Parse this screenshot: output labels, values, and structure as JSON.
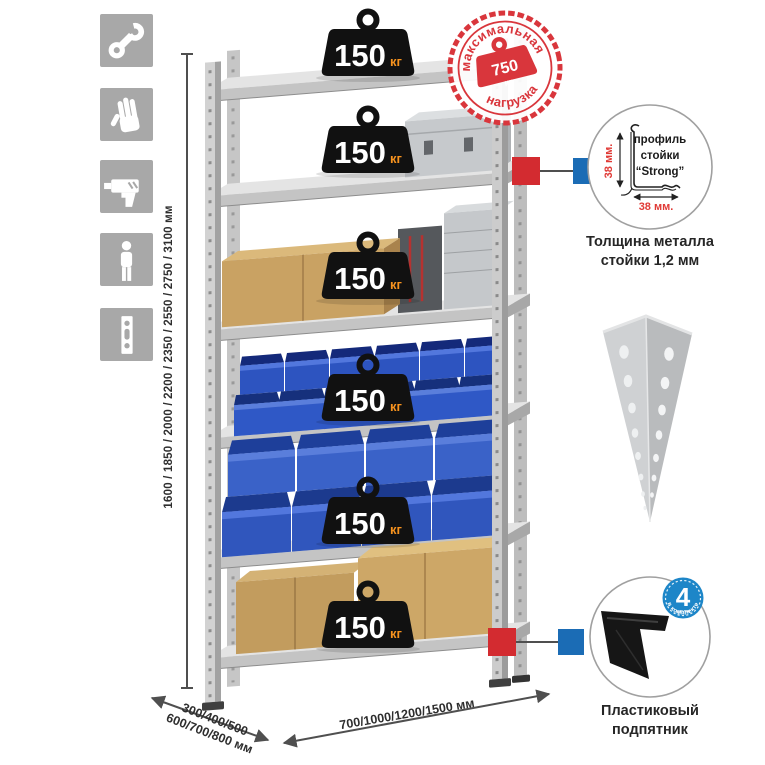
{
  "colors": {
    "icon-gray": "#a8a8a8",
    "stamp-red": "#d9363c",
    "weight-orange": "#f6921e",
    "dim-red": "#e03a36",
    "callout-red": "#d32b30",
    "callout-blue": "#1b6cb5",
    "badge-blue": "#1d86c8",
    "bin-blue": "#2d54c0",
    "metal-light": "#e4e4e4",
    "cardboard": "#c9a263"
  },
  "sidebar_icons": [
    {
      "name": "wrench-icon"
    },
    {
      "name": "work-gloves-icon"
    },
    {
      "name": "drill-icon"
    },
    {
      "name": "person-icon"
    },
    {
      "name": "rack-post-icon"
    }
  ],
  "dimensions": {
    "height": "1600 / 1850 / 2000 / 2200 / 2350 / 2550 / 2750 / 3100 мм",
    "depth_line1": "300/400/500",
    "depth_line2": "600/700/800 мм",
    "width": "700/1000/1200/1500 мм"
  },
  "weights": {
    "items": [
      {
        "value": "150",
        "unit": "кг"
      },
      {
        "value": "150",
        "unit": "кг"
      },
      {
        "value": "150",
        "unit": "кг"
      },
      {
        "value": "150",
        "unit": "кг"
      },
      {
        "value": "150",
        "unit": "кг"
      },
      {
        "value": "150",
        "unit": "кг"
      }
    ]
  },
  "stamp": {
    "arc_top": "максимальная",
    "arc_bottom": "нагрузка",
    "value": "750",
    "unit": "кг"
  },
  "profile": {
    "label_line1": "профиль",
    "label_line2": "стойки",
    "label_line3": "“Strong”",
    "vertical_dim": "38 мм.",
    "horizontal_dim": "38 мм.",
    "caption_line1": "Толщина металла",
    "caption_line2": "стойки 1,2 мм"
  },
  "foot": {
    "badge_number": "4",
    "badge_unit": "штуки",
    "badge_arc": "в комплекте",
    "caption_line1": "Пластиковый",
    "caption_line2": "подпятник"
  }
}
